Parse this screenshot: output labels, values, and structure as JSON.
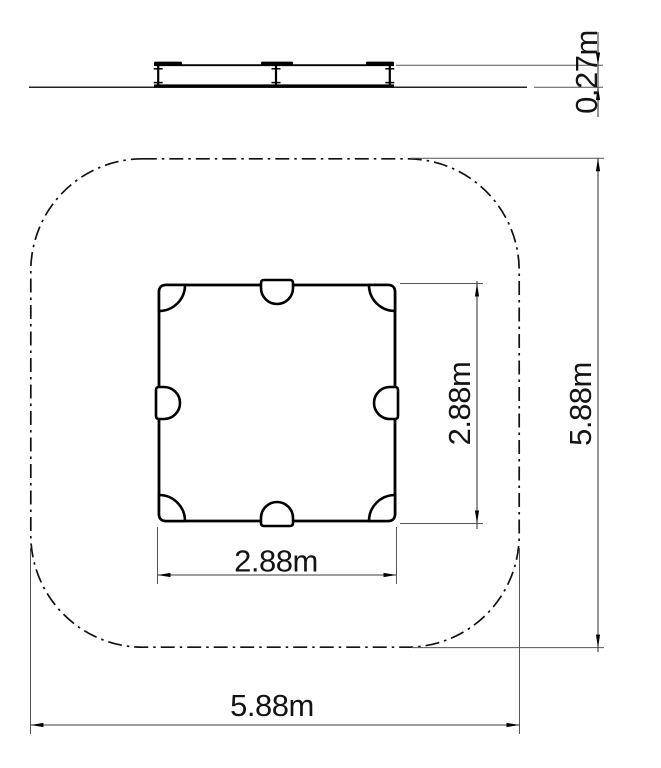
{
  "drawing": {
    "title": "Sandbox plan and elevation drawing",
    "views": {
      "elevation": "side elevation",
      "plan": "top plan view"
    },
    "dimensions": {
      "frame_height": "0.27m",
      "frame_width": "2.88m",
      "frame_depth": "2.88m",
      "safety_area_width": "5.88m",
      "safety_area_depth": "5.88m"
    },
    "elements": {
      "safety_area": "rounded-square dash-dot safety boundary",
      "frame": "square sandbox frame with 4 corner seats and 4 edge seats",
      "posts": 3
    },
    "colors": {
      "object_line": "#000000",
      "dim_line": "#3d3d3d",
      "text": "#141414",
      "background": "#ffffff"
    }
  }
}
